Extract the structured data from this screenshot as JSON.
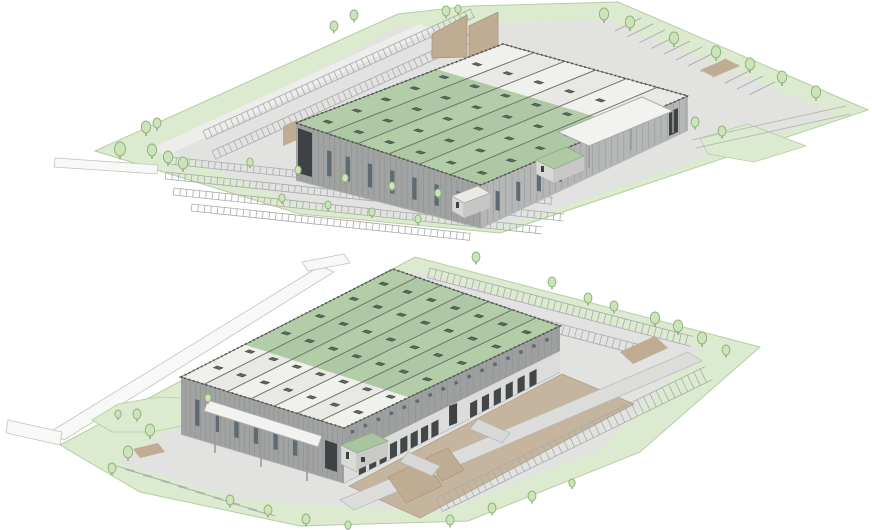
{
  "image": {
    "kind": "architectural-aerial-rendering",
    "width": 872,
    "height": 530,
    "background": "#ffffff",
    "views_count": 2
  },
  "palette": {
    "siteGreen": "#dcead0",
    "siteEdge": "#b7cda2",
    "pavement": "#e2e3e1",
    "pavementLight": "#ededeb",
    "roadWhite": "#f8f8f6",
    "roadEdge": "#c2c4c1",
    "roofGreen": "#b3cda9",
    "roofWhite": "#f0f1ed",
    "roofLine": "#707468",
    "roofEdge": "#4c504c",
    "facade": "#a0a3a1",
    "facadeLight": "#b4b7b5",
    "cladLine": "#888b89",
    "windowDark": "#5f6b74",
    "entranceDark": "#3e4244",
    "dockDoor": "#43474a",
    "dockPanel": "#dcdddb",
    "tanCourt": "#c6b59e",
    "tanPad": "#bfac92",
    "treeFill": "#cde4ba",
    "treeStroke": "#8fb47c",
    "trunk": "#8e8e7e",
    "stripe": "#a7abaa",
    "skylight": "#5c6a5c",
    "skylightEdge": "#424c42",
    "canopyWhite": "#f2f2f0",
    "structGray": "#9b9b99",
    "outline": "#9b9e9b"
  },
  "views": [
    {
      "id": "aerial-view-1",
      "building": {
        "roof_bays": 6,
        "skylight_rows_per_bay": 6,
        "front_windows": 7,
        "side_windows": 4,
        "roof_white_strip_fraction": 0.32
      },
      "site": {
        "front_parking_rows": 4,
        "back_parking_rows": 2,
        "angled_stalls": 12,
        "trees": 28
      }
    },
    {
      "id": "aerial-view-2",
      "building": {
        "roof_bays": 7,
        "skylight_rows_per_bay": 6,
        "dock_doors": 14,
        "clerestory_windows": 16,
        "front_windows": 6,
        "roof_white_strip_fraction": 0.3
      },
      "site": {
        "car_parking_rows": 2,
        "trailer_stripe_rows": 1,
        "angled_ticks": 9,
        "trees": 22
      }
    }
  ]
}
